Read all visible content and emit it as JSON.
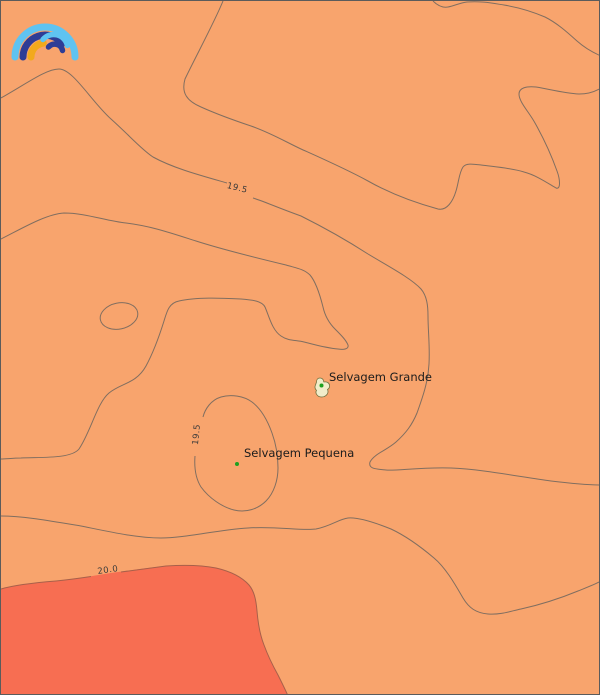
{
  "map": {
    "place_labels": [
      {
        "name": "Selvagem Grande"
      },
      {
        "name": "Selvagem Pequena"
      }
    ],
    "contour_labels": {
      "isoline_19_5_top": "19.5",
      "isoline_19_5_inner": "19.5",
      "isoline_20_0": "20.0"
    },
    "colors": {
      "sea_band_main": "#f8a46d",
      "sea_band_above_20": "#f76e52",
      "contour_line": "#806e60",
      "warm_boundary_line": "#a8604a",
      "island_fill": "#f1edca",
      "island_outline": "#72713f",
      "island_marker_green": "#1fa11f",
      "logo_light_blue": "#5fc3f1",
      "logo_navy": "#2e3d96",
      "logo_yellow": "#f2a91c"
    },
    "logo_name": "meteoblue-rainbow"
  }
}
